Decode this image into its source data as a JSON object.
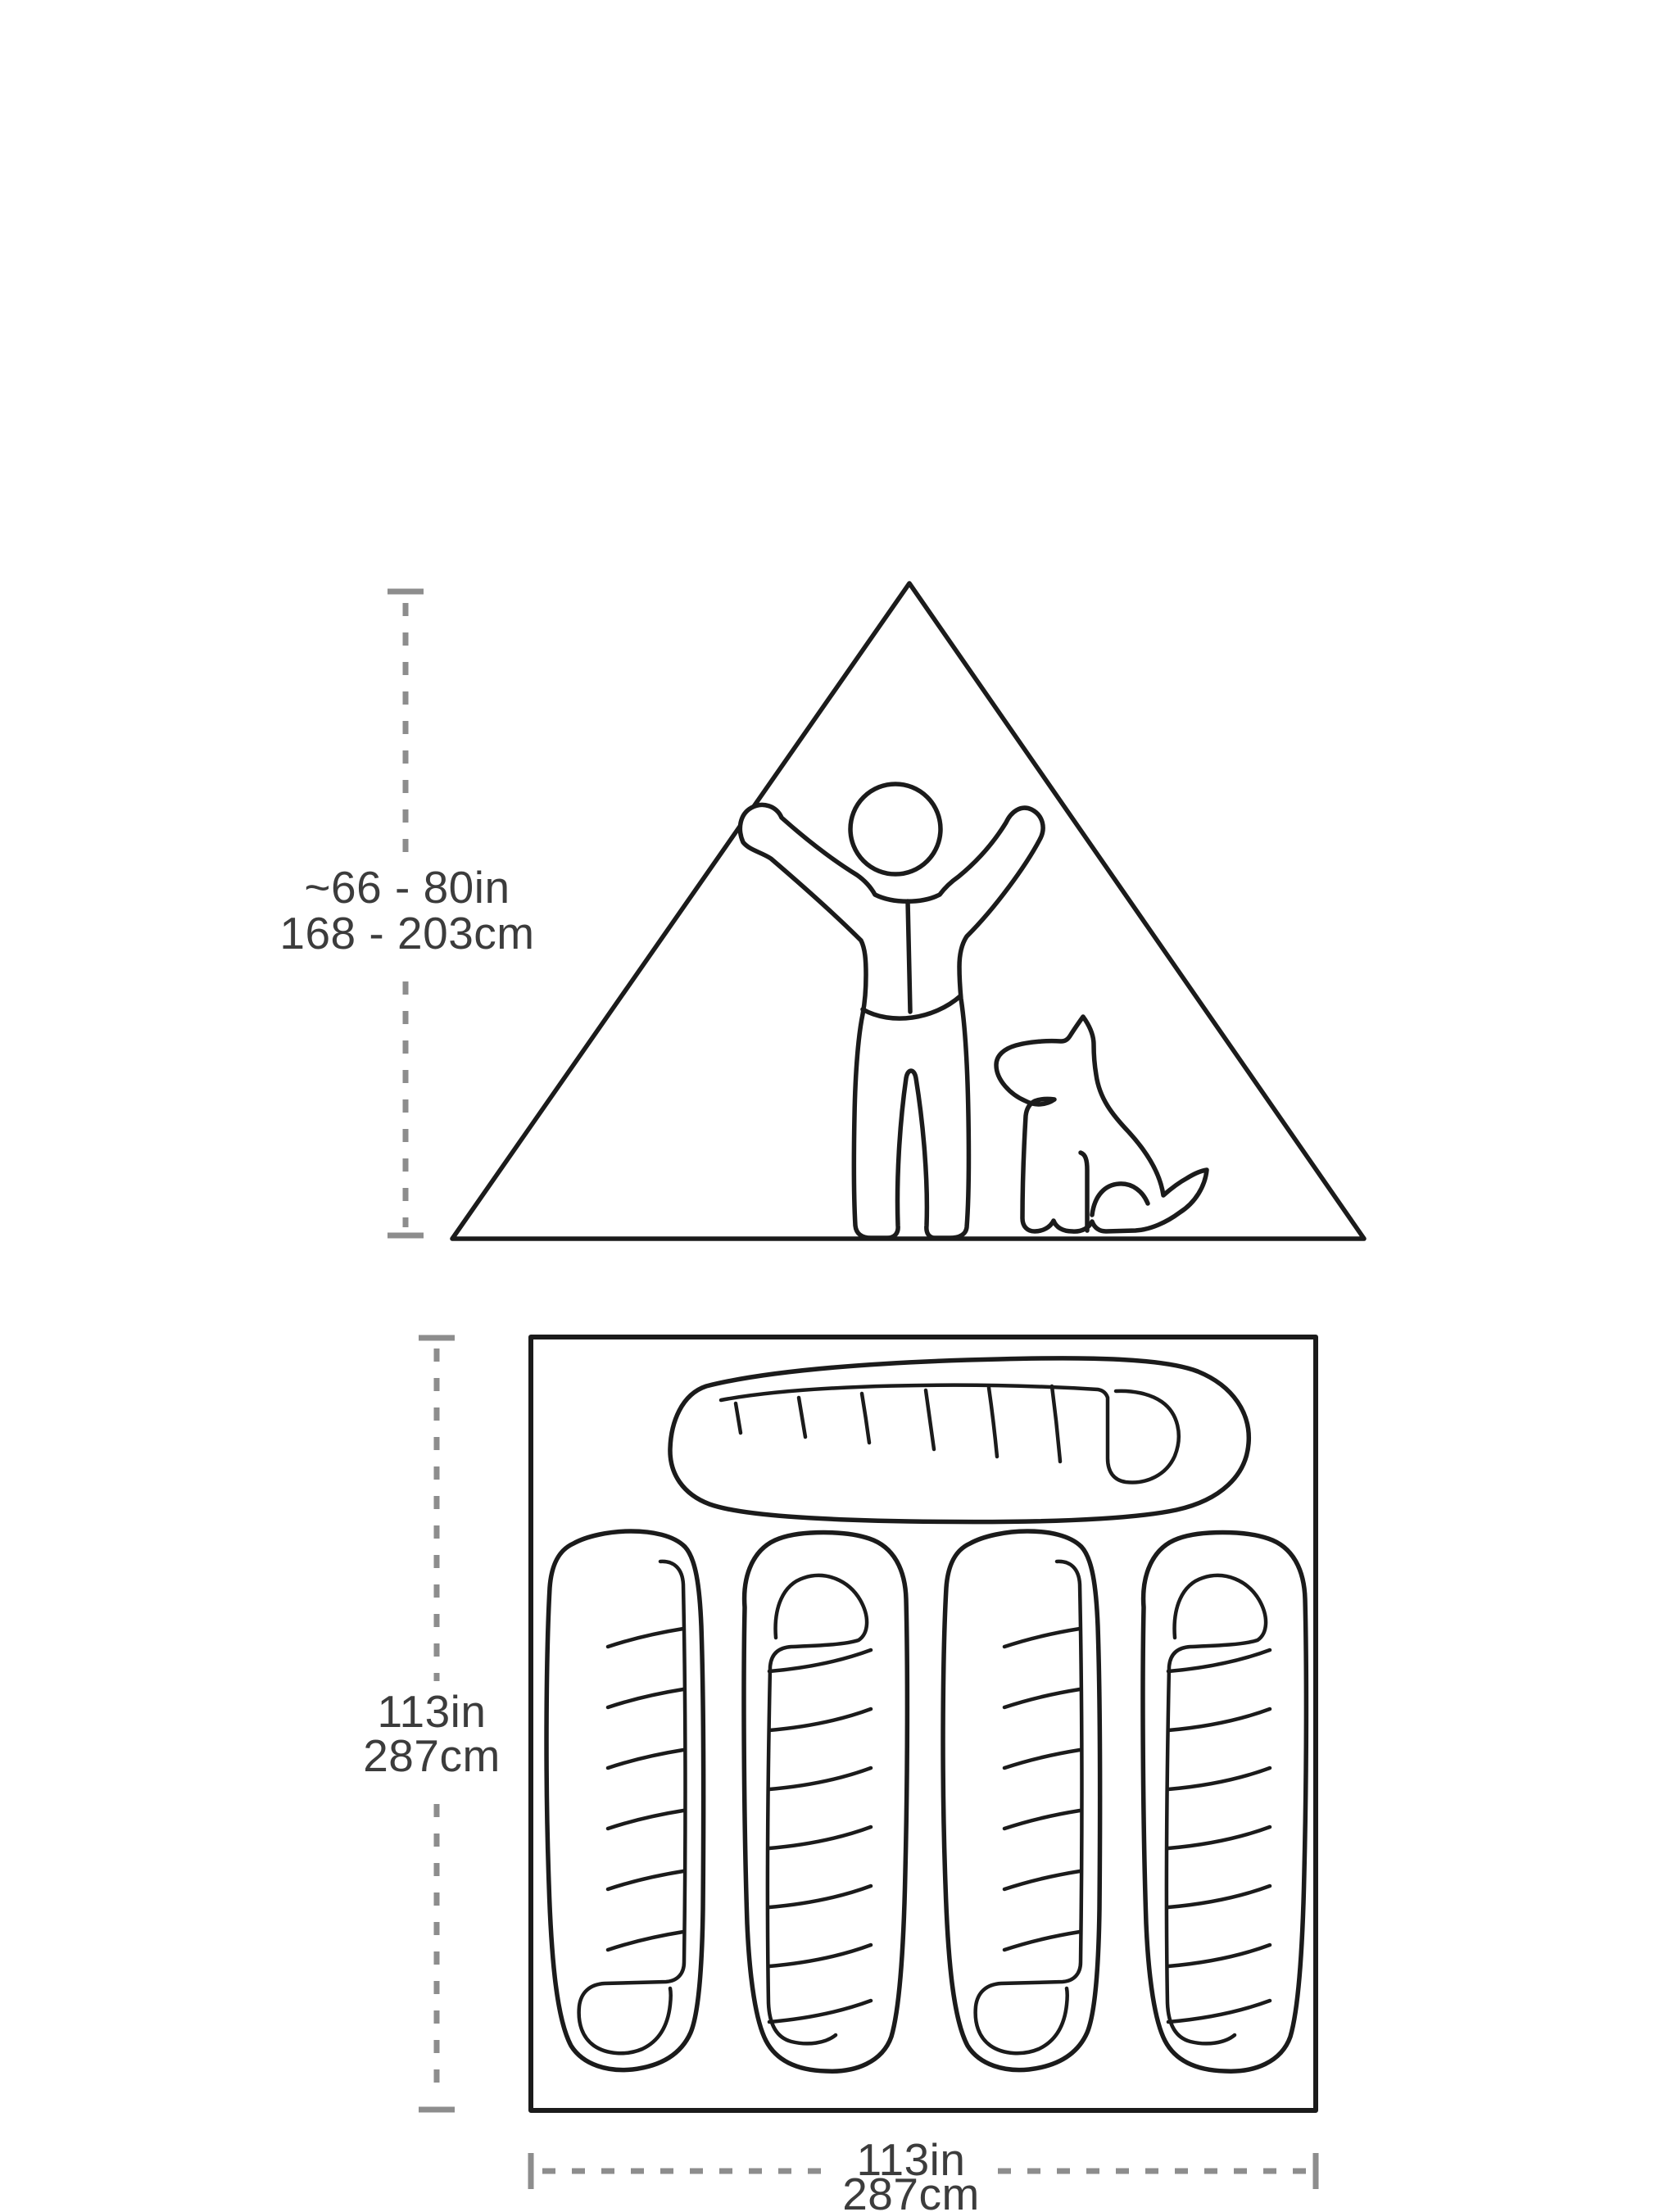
{
  "diagram": {
    "type": "tent-dimensions-spec-diagram",
    "side_view": {
      "height_label_line1": "~66 - 80in",
      "height_label_line2": "168 - 203cm"
    },
    "floor_plan": {
      "depth_label_line1": "113in",
      "depth_label_line2": "287cm",
      "width_label_line1": "113in",
      "width_label_line2": "287cm",
      "sleeping_bag_count": 5
    },
    "colors": {
      "outline": "#1b1b1b",
      "dimension_line": "#8d8d8d",
      "label_text": "#3c3c3c",
      "background": "#ffffff"
    }
  }
}
